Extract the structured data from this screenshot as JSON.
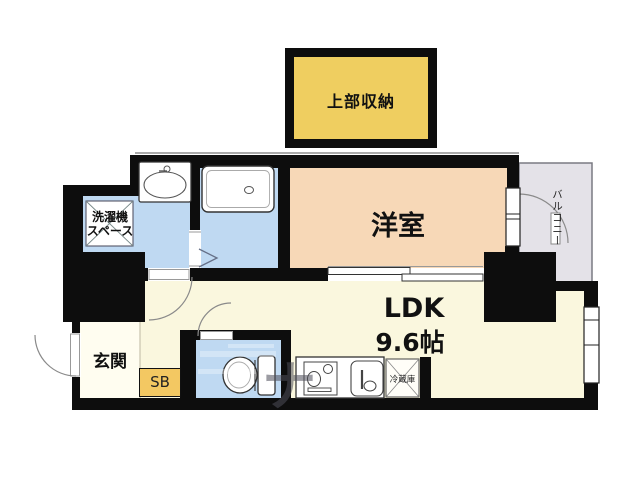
{
  "plan": {
    "storage_label": "上部収納",
    "western_room_label": "洋室",
    "ldk": {
      "line1": "LDK",
      "line2": "9.6帖"
    },
    "laundry": {
      "line1": "洗濯機",
      "line2": "スペース"
    },
    "entrance_label": "玄関",
    "shoe_box_label": "SB",
    "refrigerator_label": "冷蔵庫",
    "balcony_label": "バルコニー",
    "watermark_glyph": "ナ",
    "colors": {
      "wall": "#0d0d0d",
      "storage_fill": "#efce60",
      "western_room_fill": "#f7d8b7",
      "wet_area_fill": "#bfd9f2",
      "ldk_fill": "#faf7de",
      "entrance_fill": "#fffdf0",
      "shoe_box_fill": "#f3c862",
      "balcony_fill": "#e4e2e8"
    }
  }
}
